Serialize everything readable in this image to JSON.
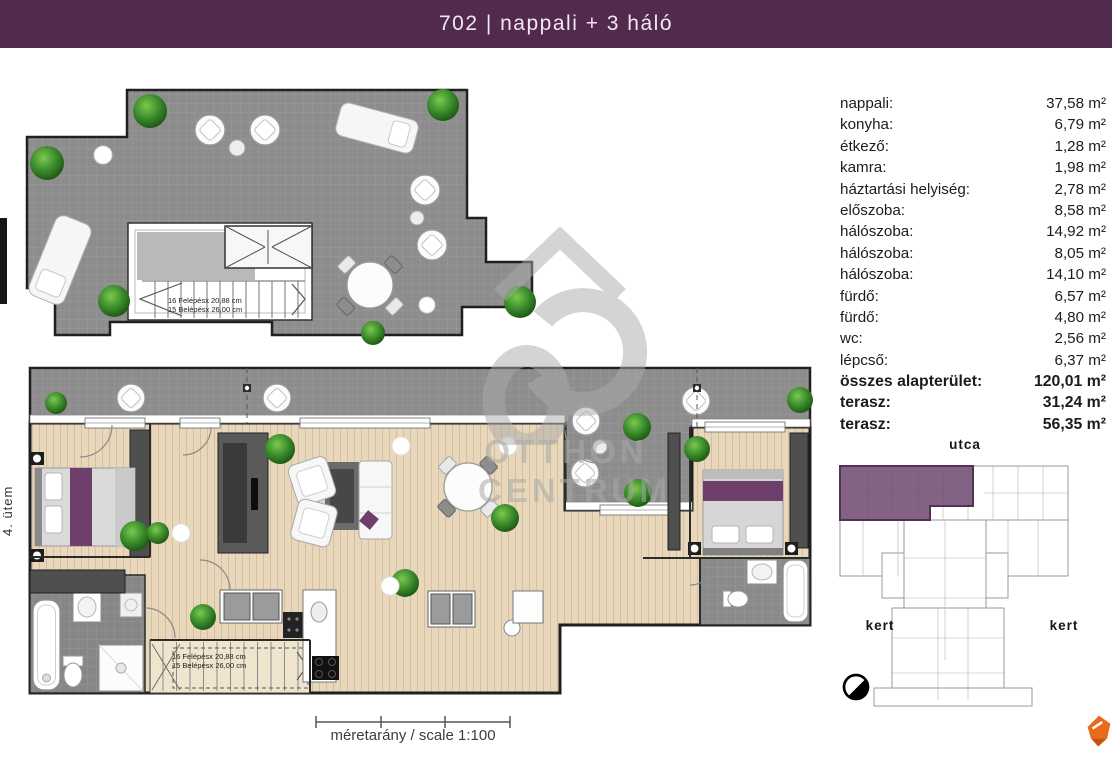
{
  "header": {
    "title": "702 | nappali + 3 háló"
  },
  "phase_label": "4. ütem",
  "area_table": {
    "rows": [
      {
        "name": "nappali:",
        "area": "37,58 m²"
      },
      {
        "name": "konyha:",
        "area": "6,79 m²"
      },
      {
        "name": "étkező:",
        "area": "1,28 m²"
      },
      {
        "name": "kamra:",
        "area": "1,98 m²"
      },
      {
        "name": "háztartási helyiség:",
        "area": "2,78 m²"
      },
      {
        "name": "előszoba:",
        "area": "8,58 m²"
      },
      {
        "name": "hálószoba:",
        "area": "14,92 m²"
      },
      {
        "name": "hálószoba:",
        "area": "8,05 m²"
      },
      {
        "name": "hálószoba:",
        "area": "14,10 m²"
      },
      {
        "name": "fürdő:",
        "area": "6,57 m²"
      },
      {
        "name": "fürdő:",
        "area": "4,80 m²"
      },
      {
        "name": "wc:",
        "area": "2,56 m²"
      },
      {
        "name": "lépcső:",
        "area": "6,37 m²"
      },
      {
        "name": "összes alapterület:",
        "area": "120,01 m²"
      },
      {
        "name": "terasz:",
        "area": "31,24 m²"
      },
      {
        "name": "terasz:",
        "area": "56,35 m²"
      }
    ]
  },
  "stairs_note": {
    "line1": "16 Felépésx 20,88 cm",
    "line2": "15 Belépésx 26,00 cm"
  },
  "scale": {
    "label": "méretarány / scale 1:100"
  },
  "site_plan": {
    "street_label": "utca",
    "garden_left": "kert",
    "garden_right": "kert"
  },
  "watermark": {
    "line1": "OTTHON",
    "line2": "CENTRUM"
  },
  "icons": {
    "compass": "compass-icon",
    "brand": "otthon-centrum-logo-icon",
    "bushes": "plant-bush",
    "watermark": "otthon-centrum-monogram"
  },
  "colors": {
    "header_bg": "#522a4e",
    "terrace_gray": "#8d8d8d",
    "wood_floor": "#e8d7ba",
    "wall": "#1f1f1f",
    "accent_purple": "#6e3f6b",
    "site_highlight_purple": "#6d486d",
    "bush_green": "#3e8f2e",
    "brand_orange": "#e96a1a"
  }
}
